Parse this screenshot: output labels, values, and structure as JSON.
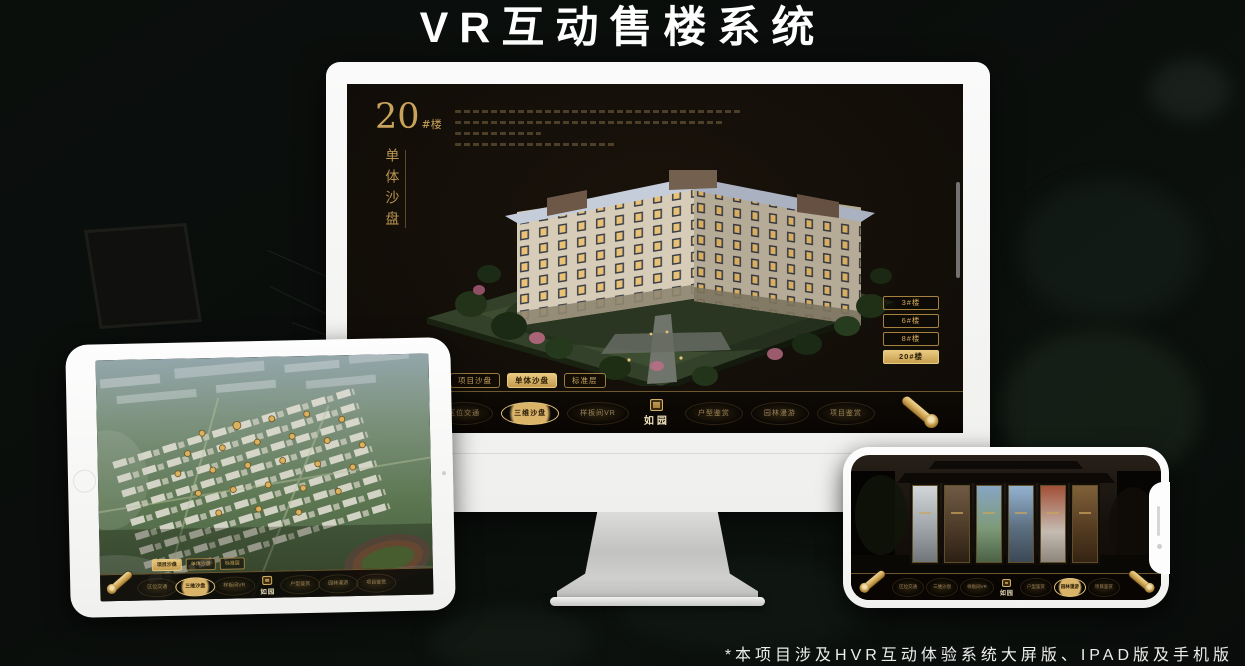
{
  "header": {
    "title": "VR互动售楼系统"
  },
  "footer": {
    "note": "*本项目涉及HVR互动体验系统大屏版、IPAD版及手机版"
  },
  "brand": {
    "name": "如园"
  },
  "colors": {
    "gold": "#c9a35c",
    "gold_bright": "#e9ca81",
    "screen_bg": "#140f09",
    "nav_bg": "#0b0805"
  },
  "monitor": {
    "title_number": "20",
    "title_suffix": "#楼",
    "subtitle": "单体沙盘",
    "floor_buttons": [
      {
        "label": "3#楼"
      },
      {
        "label": "6#楼"
      },
      {
        "label": "8#楼"
      },
      {
        "label": "20#楼"
      }
    ],
    "active_floor": "20#楼",
    "tabs": [
      {
        "label": "项目沙盘"
      },
      {
        "label": "单体沙盘"
      },
      {
        "label": "标准层"
      }
    ],
    "active_tab": "单体沙盘",
    "nav": [
      {
        "label": "区位交通"
      },
      {
        "label": "三维沙盘"
      },
      {
        "label": "样板间VR"
      },
      {
        "label": "户型鉴赏"
      },
      {
        "label": "园林漫游"
      },
      {
        "label": "项目鉴赏"
      }
    ],
    "active_nav": "三维沙盘"
  },
  "tablet": {
    "tabs": [
      {
        "label": "项目沙盘"
      },
      {
        "label": "单体沙盘"
      },
      {
        "label": "标准层"
      }
    ],
    "active_tab": "项目沙盘",
    "nav": [
      {
        "label": "区位交通"
      },
      {
        "label": "三维沙盘"
      },
      {
        "label": "样板间VR"
      },
      {
        "label": "户型鉴赏"
      },
      {
        "label": "园林漫游"
      },
      {
        "label": "项目鉴赏"
      }
    ],
    "active_nav": "三维沙盘"
  },
  "phone": {
    "nav": [
      {
        "label": "区位交通"
      },
      {
        "label": "三维沙盘"
      },
      {
        "label": "样板间VR"
      },
      {
        "label": "户型鉴赏"
      },
      {
        "label": "园林漫游"
      },
      {
        "label": "项目鉴赏"
      }
    ],
    "active_nav": "园林漫游"
  }
}
